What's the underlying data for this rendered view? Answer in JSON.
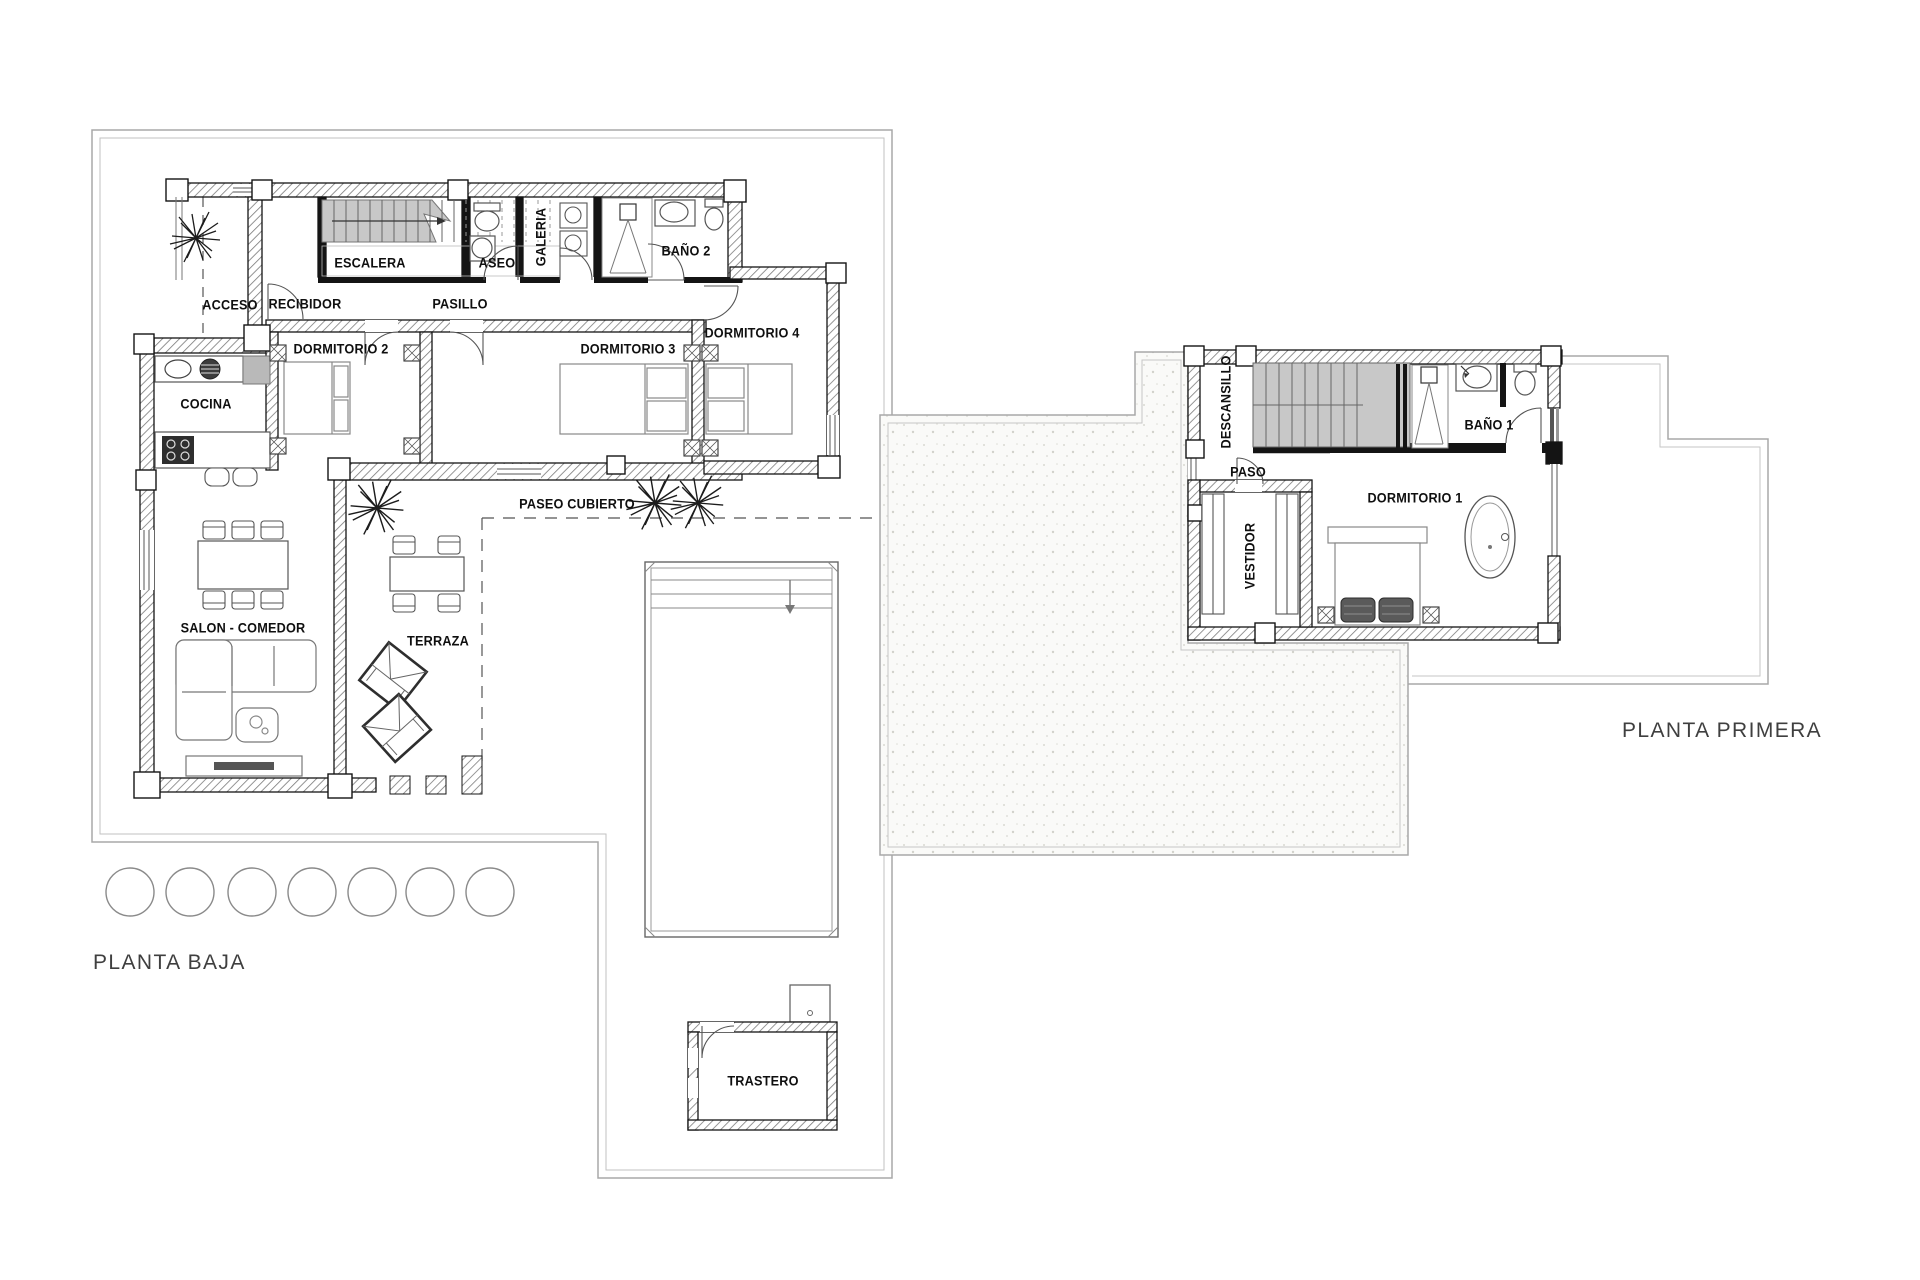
{
  "canvas": {
    "background": "#ffffff"
  },
  "ground_floor": {
    "title": "PLANTA BAJA",
    "rooms": {
      "acceso": "ACCESO",
      "recibidor": "RECIBIDOR",
      "escalera": "ESCALERA",
      "aseo": "ASEO",
      "galeria": "GALERIA",
      "bano2": "BAÑO 2",
      "pasillo": "PASILLO",
      "dormitorio2": "DORMITORIO 2",
      "dormitorio3": "DORMITORIO 3",
      "dormitorio4": "DORMITORIO 4",
      "cocina": "COCINA",
      "salon_comedor": "SALON - COMEDOR",
      "terraza": "TERRAZA",
      "paseo_cubierto": "PASEO CUBIERTO",
      "trastero": "TRASTERO"
    }
  },
  "first_floor": {
    "title": "PLANTA PRIMERA",
    "rooms": {
      "descansillo": "DESCANSILLO",
      "paso": "PASO",
      "bano1": "BAÑO 1",
      "dormitorio1": "DORMITORIO 1",
      "vestidor": "VESTIDOR"
    }
  },
  "colors": {
    "wall": "#141414",
    "plot_boundary": "#a8a8a8",
    "stairs_fill": "#c8c8c8",
    "label": "#0f0f0f",
    "title": "#3f3f3f"
  }
}
